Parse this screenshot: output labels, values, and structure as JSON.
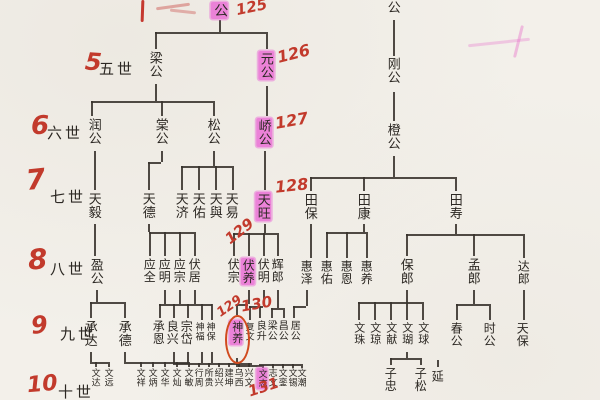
{
  "document_type": "chinese-genealogy-tree-scan",
  "colors": {
    "paper": "#f3f0ea",
    "ink": "#2c2823",
    "highlighter_pink": "#e964d4",
    "handwriting_red": "#c23a2c",
    "circle_orange_red": "#d14a1e"
  },
  "generations": [
    {
      "red_number": null,
      "label": null,
      "names": [
        {
          "t": "公",
          "x": 219,
          "y": 2,
          "s": 14,
          "hl": true
        },
        {
          "t": "景公",
          "x": 393,
          "y": -13,
          "s": 13
        }
      ],
      "annotations": [
        {
          "t": "125",
          "x": 236,
          "y": 0,
          "r": -12,
          "s": 15
        }
      ]
    },
    {
      "red_number": {
        "t": "5",
        "x": 85,
        "y": 50,
        "s": 24,
        "r": 4
      },
      "label": {
        "t": "五世",
        "x": 99,
        "y": 58
      },
      "names": [
        {
          "t": "梁公",
          "x": 155,
          "y": 51,
          "s": 13
        },
        {
          "t": "元公",
          "x": 266,
          "y": 51,
          "s": 13,
          "hl": true
        },
        {
          "t": "刚公",
          "x": 393,
          "y": 57,
          "s": 13
        }
      ],
      "annotations": [
        {
          "t": "126",
          "x": 277,
          "y": 46,
          "r": -14,
          "s": 16
        }
      ]
    },
    {
      "red_number": {
        "t": "6",
        "x": 31,
        "y": 113,
        "s": 26,
        "r": 0
      },
      "label": {
        "t": "六世",
        "x": 47,
        "y": 122
      },
      "names": [
        {
          "t": "润公",
          "x": 94,
          "y": 118,
          "s": 13
        },
        {
          "t": "棠公",
          "x": 161,
          "y": 118,
          "s": 13
        },
        {
          "t": "松公",
          "x": 213,
          "y": 118,
          "s": 13
        },
        {
          "t": "峤公",
          "x": 264,
          "y": 118,
          "s": 13,
          "hl": true
        },
        {
          "t": "橙公",
          "x": 393,
          "y": 123,
          "s": 13
        }
      ],
      "annotations": [
        {
          "t": "127",
          "x": 275,
          "y": 113,
          "r": -10,
          "s": 16
        }
      ]
    },
    {
      "red_number": {
        "t": "7",
        "x": 26,
        "y": 166,
        "s": 28,
        "r": -6
      },
      "label": {
        "t": "七世",
        "x": 50,
        "y": 186
      },
      "names": [
        {
          "t": "天毅",
          "x": 94,
          "y": 192,
          "s": 13
        },
        {
          "t": "天德",
          "x": 148,
          "y": 192,
          "s": 13
        },
        {
          "t": "天济",
          "x": 181,
          "y": 192,
          "s": 13
        },
        {
          "t": "天佑",
          "x": 198,
          "y": 192,
          "s": 13
        },
        {
          "t": "天與",
          "x": 215,
          "y": 192,
          "s": 13
        },
        {
          "t": "天易",
          "x": 231,
          "y": 192,
          "s": 13
        },
        {
          "t": "天旺",
          "x": 263,
          "y": 192,
          "s": 13,
          "hl": true
        },
        {
          "t": "田保",
          "x": 310,
          "y": 193,
          "s": 13
        },
        {
          "t": "田康",
          "x": 363,
          "y": 193,
          "s": 13
        },
        {
          "t": "田寿",
          "x": 455,
          "y": 193,
          "s": 13
        }
      ],
      "annotations": [
        {
          "t": "128",
          "x": 275,
          "y": 178,
          "r": -6,
          "s": 16
        }
      ]
    },
    {
      "red_number": {
        "t": "8",
        "x": 28,
        "y": 246,
        "s": 28,
        "r": -4
      },
      "label": {
        "t": "八世",
        "x": 50,
        "y": 258
      },
      "names": [
        {
          "t": "盈公",
          "x": 96,
          "y": 258,
          "s": 13
        },
        {
          "t": "应全",
          "x": 149,
          "y": 258,
          "s": 12
        },
        {
          "t": "应明",
          "x": 164,
          "y": 258,
          "s": 12
        },
        {
          "t": "应宗",
          "x": 179,
          "y": 258,
          "s": 12
        },
        {
          "t": "伏居",
          "x": 194,
          "y": 258,
          "s": 12
        },
        {
          "t": "伏宗",
          "x": 233,
          "y": 258,
          "s": 12
        },
        {
          "t": "伏养",
          "x": 248,
          "y": 258,
          "s": 12,
          "hl": true
        },
        {
          "t": "伏明",
          "x": 263,
          "y": 258,
          "s": 12
        },
        {
          "t": "辉郎",
          "x": 277,
          "y": 258,
          "s": 12
        },
        {
          "t": "惠泽",
          "x": 306,
          "y": 260,
          "s": 12
        },
        {
          "t": "惠佑",
          "x": 326,
          "y": 260,
          "s": 12
        },
        {
          "t": "惠恩",
          "x": 346,
          "y": 260,
          "s": 12
        },
        {
          "t": "惠养",
          "x": 366,
          "y": 260,
          "s": 12
        },
        {
          "t": "保郎",
          "x": 406,
          "y": 258,
          "s": 13
        },
        {
          "t": "孟郎",
          "x": 473,
          "y": 258,
          "s": 13
        },
        {
          "t": "达郎",
          "x": 523,
          "y": 260,
          "s": 12
        }
      ],
      "annotations": [
        {
          "t": "129",
          "x": 224,
          "y": 224,
          "r": -38,
          "s": 15
        }
      ]
    },
    {
      "red_number": {
        "t": "9",
        "x": 31,
        "y": 313,
        "s": 24,
        "r": -6
      },
      "label": {
        "t": "九世",
        "x": 60,
        "y": 323
      },
      "names": [
        {
          "t": "承达",
          "x": 90,
          "y": 320,
          "s": 13
        },
        {
          "t": "承德",
          "x": 124,
          "y": 320,
          "s": 13
        },
        {
          "t": "承恩",
          "x": 158,
          "y": 320,
          "s": 12
        },
        {
          "t": "良兴",
          "x": 172,
          "y": 320,
          "s": 12
        },
        {
          "t": "宗岱",
          "x": 186,
          "y": 320,
          "s": 12
        },
        {
          "t": "神福",
          "x": 199,
          "y": 322,
          "s": 9
        },
        {
          "t": "神保",
          "x": 210,
          "y": 322,
          "s": 9
        },
        {
          "t": "神养",
          "x": 236,
          "y": 320,
          "s": 11,
          "hl": true,
          "circled": true
        },
        {
          "t": "复文",
          "x": 249,
          "y": 322,
          "s": 9
        },
        {
          "t": "良升",
          "x": 259,
          "y": 320,
          "s": 10
        },
        {
          "t": "梁公",
          "x": 270,
          "y": 320,
          "s": 10
        },
        {
          "t": "昌公",
          "x": 281,
          "y": 320,
          "s": 10
        },
        {
          "t": "居公",
          "x": 293,
          "y": 320,
          "s": 10
        },
        {
          "t": "文珠",
          "x": 358,
          "y": 322,
          "s": 11
        },
        {
          "t": "文琼",
          "x": 374,
          "y": 322,
          "s": 11
        },
        {
          "t": "文献",
          "x": 390,
          "y": 322,
          "s": 11
        },
        {
          "t": "文瑚",
          "x": 406,
          "y": 322,
          "s": 11
        },
        {
          "t": "文球",
          "x": 422,
          "y": 322,
          "s": 11
        },
        {
          "t": "春公",
          "x": 456,
          "y": 322,
          "s": 12
        },
        {
          "t": "时公",
          "x": 489,
          "y": 322,
          "s": 12
        },
        {
          "t": "天保",
          "x": 522,
          "y": 322,
          "s": 12
        }
      ],
      "annotations": [
        {
          "t": "129",
          "x": 216,
          "y": 300,
          "r": -35,
          "s": 13
        },
        {
          "t": "130",
          "x": 241,
          "y": 297,
          "r": -10,
          "s": 15
        }
      ]
    },
    {
      "red_number": {
        "t": "10",
        "x": 27,
        "y": 374,
        "s": 22,
        "r": -5
      },
      "label": {
        "t": "十世",
        "x": 58,
        "y": 381
      },
      "names": [
        {
          "t": "文达",
          "x": 95,
          "y": 368,
          "s": 9
        },
        {
          "t": "文远",
          "x": 108,
          "y": 368,
          "s": 9
        },
        {
          "t": "文祥",
          "x": 140,
          "y": 368,
          "s": 9
        },
        {
          "t": "文炳",
          "x": 152,
          "y": 368,
          "s": 9
        },
        {
          "t": "文华",
          "x": 164,
          "y": 368,
          "s": 9
        },
        {
          "t": "文灿",
          "x": 176,
          "y": 368,
          "s": 9
        },
        {
          "t": "文敏",
          "x": 188,
          "y": 368,
          "s": 9
        },
        {
          "t": "行周",
          "x": 198,
          "y": 368,
          "s": 9
        },
        {
          "t": "所贵",
          "x": 208,
          "y": 368,
          "s": 9
        },
        {
          "t": "绍兴",
          "x": 218,
          "y": 368,
          "s": 9
        },
        {
          "t": "建坤",
          "x": 228,
          "y": 368,
          "s": 9
        },
        {
          "t": "乌西",
          "x": 238,
          "y": 368,
          "s": 9
        },
        {
          "t": "兴文",
          "x": 248,
          "y": 368,
          "s": 9
        },
        {
          "t": "文志",
          "x": 262,
          "y": 368,
          "s": 9,
          "hl": true
        },
        {
          "t": "志文",
          "x": 272,
          "y": 368,
          "s": 9
        },
        {
          "t": "文銮",
          "x": 282,
          "y": 368,
          "s": 9
        },
        {
          "t": "文锡",
          "x": 292,
          "y": 368,
          "s": 9
        },
        {
          "t": "文潮",
          "x": 301,
          "y": 368,
          "s": 9
        },
        {
          "t": "子忠",
          "x": 390,
          "y": 367,
          "s": 12
        },
        {
          "t": "子松",
          "x": 420,
          "y": 367,
          "s": 12
        },
        {
          "t": "延",
          "x": 437,
          "y": 370,
          "s": 12
        }
      ],
      "annotations": [
        {
          "t": "131",
          "x": 248,
          "y": 380,
          "r": -18,
          "s": 15
        }
      ]
    }
  ]
}
